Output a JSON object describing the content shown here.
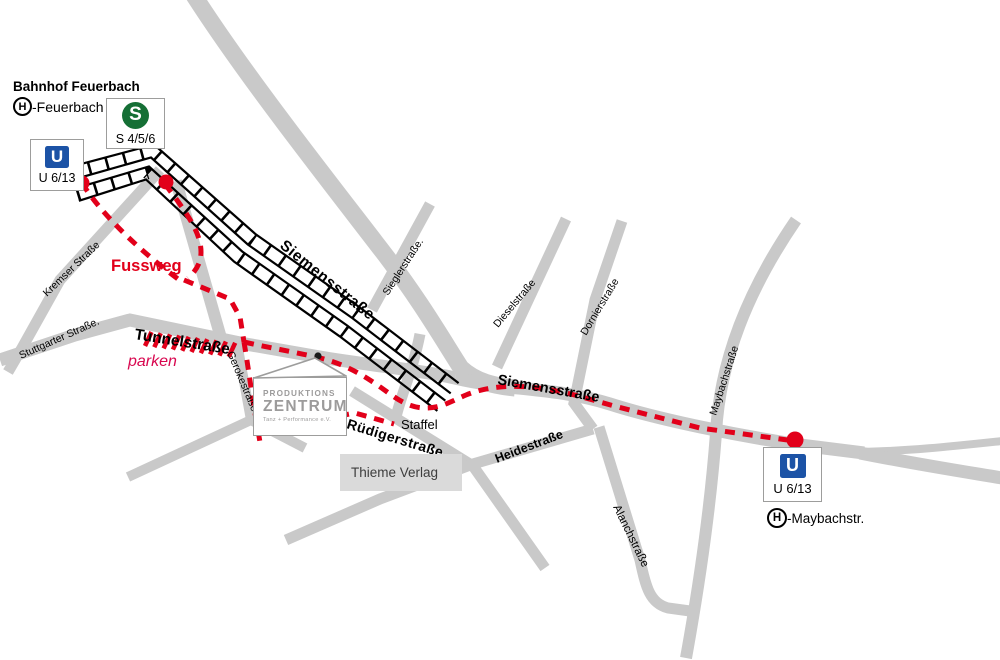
{
  "colors": {
    "road_gray": "#c9c9c9",
    "rail_black": "#000000",
    "route_red": "#e2001a",
    "parken_pink": "#d8074f",
    "u_bahn_blue": "#1c53a6",
    "s_bahn_green": "#156f35",
    "box_border_gray": "#9d9d9c",
    "verlag_bg": "#dadada",
    "logo_gray": "#9c9b9b",
    "logo_yellow": "#ffcc00"
  },
  "bahnhof": {
    "title": "Bahnhof Feuerbach",
    "h_symbol": "H",
    "stop": "-Feuerbach"
  },
  "stations": {
    "u_top": {
      "symbol": "U",
      "lines": "U 6/13"
    },
    "s_top": {
      "symbol": "S",
      "lines": "S 4/5/6"
    },
    "u_bottom": {
      "symbol": "U",
      "lines": "U 6/13"
    },
    "h_bottom": {
      "symbol": "H",
      "stop": "-Maybachstr."
    }
  },
  "venue": {
    "name_line1": "PRODUKTIONS",
    "name_line2": "ZENTRUM",
    "name_line3": "Tanz + Performance e.V."
  },
  "annotations": {
    "fussweg": "Fussweg",
    "parken": "parken",
    "staffel": "Staffel",
    "thieme_verlag": "Thieme Verlag"
  },
  "streets": {
    "siemens_upper": "Siemensstraße",
    "siemens_lower": "Siemensstraße",
    "kremser": "Kremser Straße",
    "stuttgarter": "Stuttgarter Straße.",
    "tunnel": "Tunnelstraße",
    "geroke": "Gerokestraße",
    "siegler": "Sieglerstraße.",
    "diesel": "Dieselstraße",
    "dornier": "Dornierstraße",
    "maybach": "Maybachstraße",
    "ruediger": "Rüdigerstraße",
    "heide": "Heidestraße",
    "alanch": "Alanchstraße"
  }
}
